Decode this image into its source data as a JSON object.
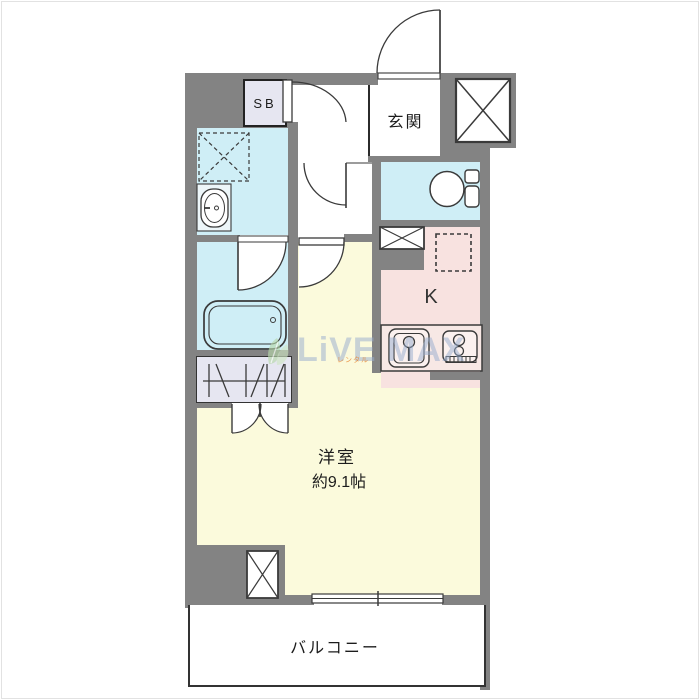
{
  "title": "floor-plan",
  "labels": {
    "sb": "SB",
    "genkan": "玄関",
    "kitchen_k": "K",
    "room_title": "洋室",
    "room_area": "約9.1帖",
    "balcony": "バルコニー"
  },
  "watermark": {
    "brand": "LiVE MAX",
    "sub": "レンタル",
    "leaf_icon": "leaf-icon"
  },
  "icons": {
    "entrance_door": "swing-door-arc",
    "interior_doors": "swing-door-arc",
    "closet_doors": "double-swing-door-arcs",
    "toilet": "toilet-bowl-and-tank",
    "bathtub": "rounded-bathtub",
    "washbasin": "vanity-basin-oval",
    "washing_machine": "dashed-square-with-x",
    "refrigerator_space": "dashed-square",
    "kitchen_sink": "sink-with-faucet",
    "stove": "two-burner-stove-with-grill",
    "pipe_space": "box-with-x",
    "closet_rail": "hanger-pipe-symbol",
    "balcony_window": "sliding-window-lines"
  },
  "colors": {
    "wall": "#838383",
    "water": "#cfeef6",
    "kitchen": "#f8e2e0",
    "counter": "#f7e8e5",
    "fixture": "#fbf1ef",
    "room": "#fbfadc",
    "closet": "#e6e6f1",
    "line": "#3a3a3a",
    "wm": "rgba(150,172,205,0.60)",
    "wm_sub": "rgba(232,130,44,0.80)",
    "leaf": "#b7d8ab"
  }
}
